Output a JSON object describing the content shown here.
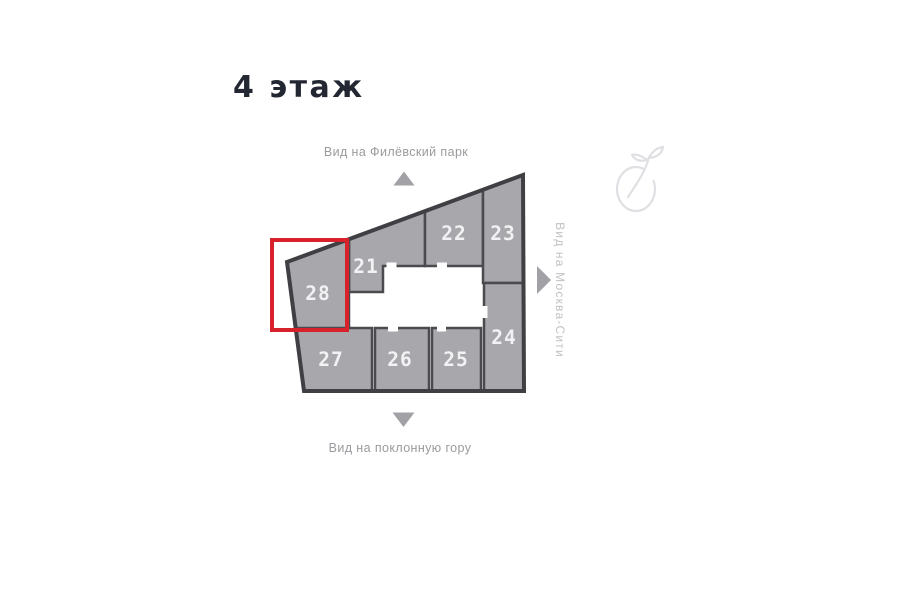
{
  "page": {
    "title": "4 этаж",
    "background": "#ffffff"
  },
  "plan": {
    "views": {
      "top": "Вид на Филёвский парк",
      "bottom": "Вид на поклонную гору",
      "right": "Вид на Москва-Сити"
    },
    "units": [
      {
        "number": "21"
      },
      {
        "number": "22"
      },
      {
        "number": "23"
      },
      {
        "number": "24"
      },
      {
        "number": "25"
      },
      {
        "number": "26"
      },
      {
        "number": "27"
      },
      {
        "number": "28"
      }
    ],
    "highlighted_unit": "28",
    "colors": {
      "unit_fill": "#a8a8ac",
      "wall": "#4b4b4f",
      "outline": "#404044",
      "unit_number": "#f2f2f4",
      "highlight": "#d7222b",
      "label": "#9b9b9f",
      "label_light": "#c2c2c6",
      "arrow": "#a2a2a6",
      "title": "#232732",
      "watermark": "#e0e0e4"
    }
  }
}
